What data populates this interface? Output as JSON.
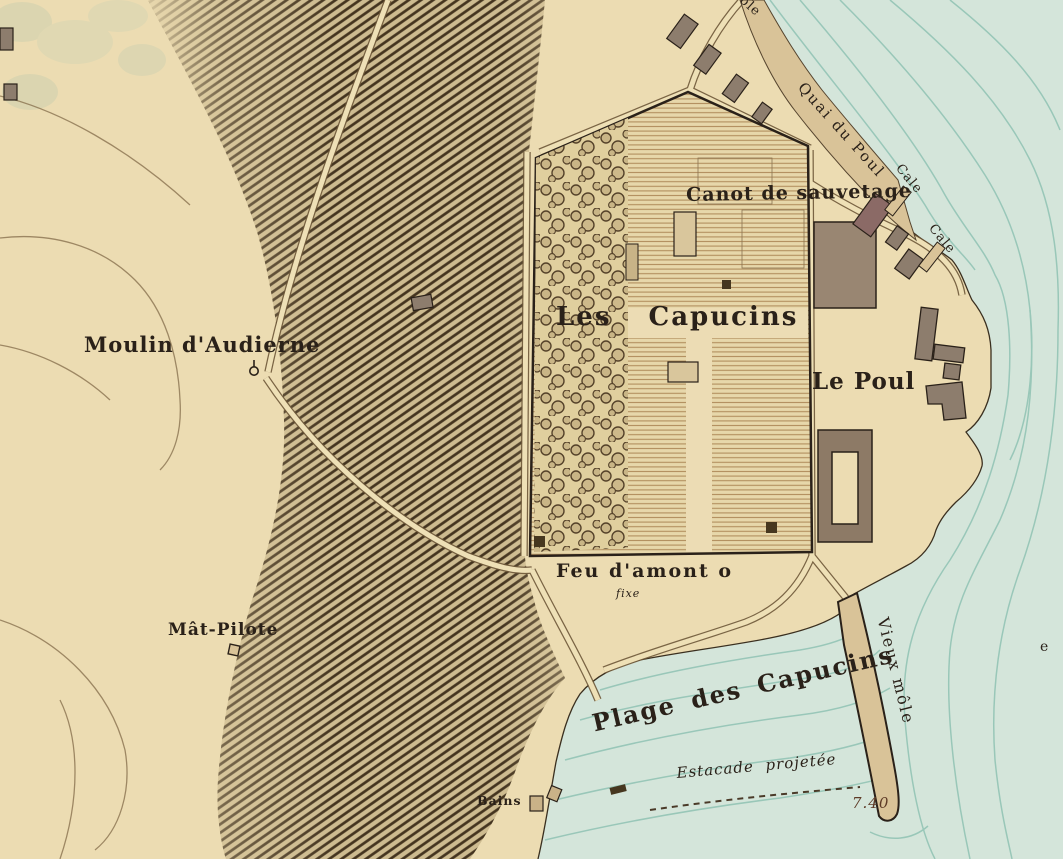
{
  "labels": {
    "moulin": "Moulin d'Audierne",
    "mat_pilote": "Mât-Pilote",
    "les_capucins": "Les Capucins",
    "canot": "Canot de sauvetage",
    "le_poul": "Le Poul",
    "quai_du_poul": "Quai du Poul",
    "cale_1": "Cale",
    "cale_2": "Cale",
    "feu_damont": "Feu d'amont o",
    "feu_damont_note": "fixe",
    "plage": "Plage des Capucins",
    "estacade": "Estacade projetée",
    "vieux_mole": "Vieux môle",
    "sounding": "7.40",
    "bains": "Bains",
    "edge_top_partial": "ôle",
    "edge_right_partial": "e"
  },
  "colors": {
    "paper": "#ecdcb2",
    "water": "#d4e5da",
    "contour": "#8fc2b3",
    "hill_ink": "#46371f",
    "building": "#8d7d6d",
    "building_red": "#8b6a66",
    "pier_sand": "#d9c398",
    "ink": "#2a2119",
    "sounding_ink": "#5d3a26"
  }
}
